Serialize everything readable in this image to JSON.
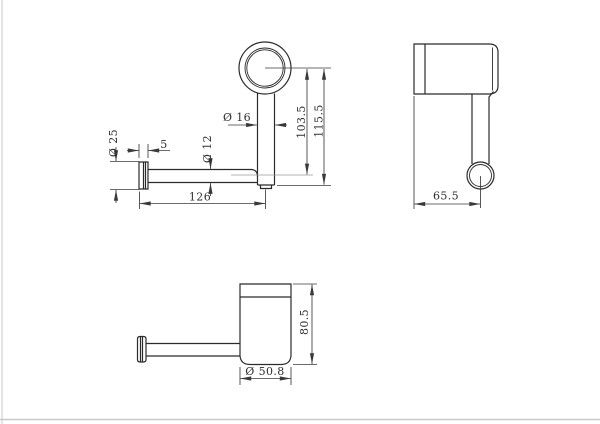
{
  "drawing": {
    "kind": "technical-dimension-drawing",
    "subject": "wall-mounted toilet roll / hook holder, three orthographic views",
    "background": "#ffffff",
    "line_color": "#2b2b2b",
    "dim_color": "#3a3a3a",
    "light_ext_color": "#9a9a9a",
    "frame_color": "#c9c9c9"
  },
  "views": {
    "front": {
      "title": "front view (ring, post, arm and wall flange)",
      "dims": {
        "post_dia": "Ø 16",
        "arm_dia": "Ø 12",
        "flange_dia": "Ø 25",
        "flange_depth": "5",
        "center_height": "103.5",
        "total_height": "115.5",
        "arm_length": "126"
      }
    },
    "side": {
      "title": "side view (ring edge with hanging post)",
      "dims": {
        "depth": "65.5"
      }
    },
    "bottom": {
      "title": "top view (ring with arm and wall flange)",
      "dims": {
        "depth": "80.5",
        "ring_dia": "Ø 50.8"
      }
    }
  }
}
